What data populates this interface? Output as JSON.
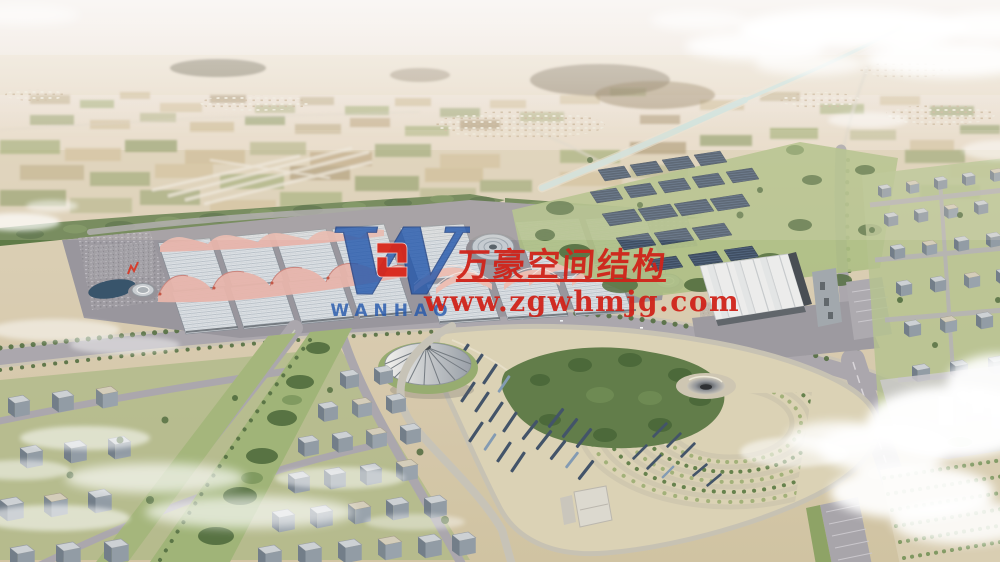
{
  "watermark": {
    "company_cn": "万豪空间结构",
    "website": "www.zgwhmjg.com",
    "logo_letter": "W",
    "logo_text": "WANHAO",
    "text_color": "#d0231a",
    "logo_color": "#2257ac",
    "emblem_color": "#d8271b"
  }
}
